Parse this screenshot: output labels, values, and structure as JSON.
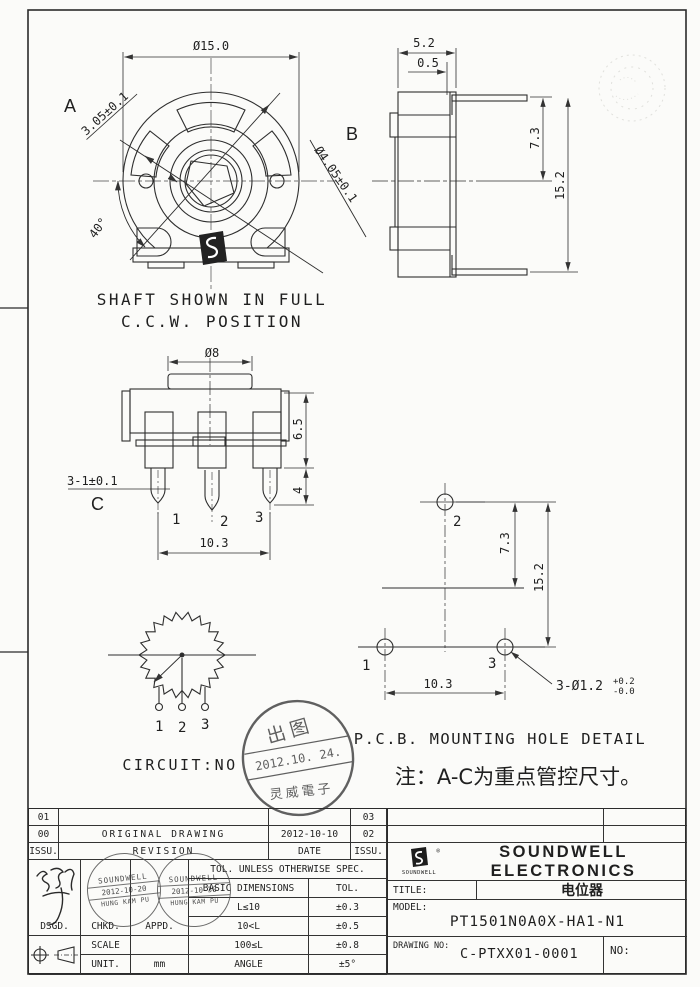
{
  "sheet": {
    "note": "注：A-C为重点管控尺寸。",
    "pcb_title": "P.C.B. MOUNTING HOLE DETAIL"
  },
  "front_view": {
    "dim_body_dia": "Ø15.0",
    "label_a": "A",
    "dim_a": "3.05±0.1",
    "label_b": "B",
    "dim_b": "Ø4.05±0.1",
    "dim_angle": "40°",
    "caption1": "SHAFT SHOWN IN FULL",
    "caption2": "C.C.W. POSITION"
  },
  "side_view": {
    "dim_depth": "5.2",
    "dim_step": "0.5",
    "dim_center": "7.3",
    "dim_height": "15.2"
  },
  "bottom_view": {
    "dim_shaft_dia": "Ø8",
    "dim_pin_width": "3-1±0.1",
    "label_c": "C",
    "pin1": "1",
    "pin2": "2",
    "pin3": "3",
    "dim_body_h": "6.5",
    "dim_pin_len": "4",
    "dim_pin_span": "10.3"
  },
  "circuit": {
    "label": "CIRCUIT:NO",
    "pin1": "1",
    "pin2": "2",
    "pin3": "3"
  },
  "pcb_view": {
    "hole1": "1",
    "hole2": "2",
    "hole3": "3",
    "dim_center": "7.3",
    "dim_height": "15.2",
    "dim_span": "10.3",
    "dim_hole": "3-Ø1.2",
    "tol_plus": "+0.2",
    "tol_minus": "-0.0"
  },
  "release_stamp": {
    "top": "出图",
    "date": "2012.10. 24.",
    "bottom": "灵威電子"
  },
  "revision": {
    "r1_issu": "01",
    "r1_rev": "",
    "r1_date": "",
    "r1_issu2": "03",
    "r2_issu": "00",
    "r2_rev": "ORIGINAL DRAWING",
    "r2_date": "2012-10-10",
    "r2_issu2": "02",
    "h_issu": "ISSU.",
    "h_rev": "REVISION",
    "h_date": "DATE",
    "h_issu2": "ISSU."
  },
  "title_block": {
    "company": "SOUNDWELL ELECTRONICS",
    "logo_caption": "SOUNDWELL",
    "reg_mark": "®",
    "title_label": "TITLE:",
    "title_value": "电位器",
    "model_label": "MODEL:",
    "model_value": "PT1501N0A0X-HA1-N1",
    "drawing_no_label": "DRAWING NO:",
    "drawing_no_value": "C-PTXX01-0001",
    "no_label": "NO:",
    "dsgd": "DSGD.",
    "chkd": "CHKD.",
    "appd": "APPD.",
    "scale_label": "SCALE",
    "scale_value": "",
    "unit_label": "UNIT.",
    "unit_value": "mm",
    "tol_header": "TOL. UNLESS OTHERWISE SPEC.",
    "basic_dim": "BASIC DIMENSIONS",
    "tol": "TOL.",
    "tol_rows": [
      {
        "range": "L≤10",
        "tol": "±0.3"
      },
      {
        "range": "10<L",
        "tol": "±0.5"
      },
      {
        "range": "100≤L",
        "tol": "±0.8"
      },
      {
        "range": "ANGLE",
        "tol": "±5°"
      }
    ],
    "approve_stamps": [
      {
        "company": "SOUNDWELL",
        "date": "2012-10-20",
        "name": "HUNG KAM PU"
      },
      {
        "company": "SOUNDWELL",
        "date": "2012-10-30",
        "name": "HUNG KAM PU"
      }
    ]
  }
}
